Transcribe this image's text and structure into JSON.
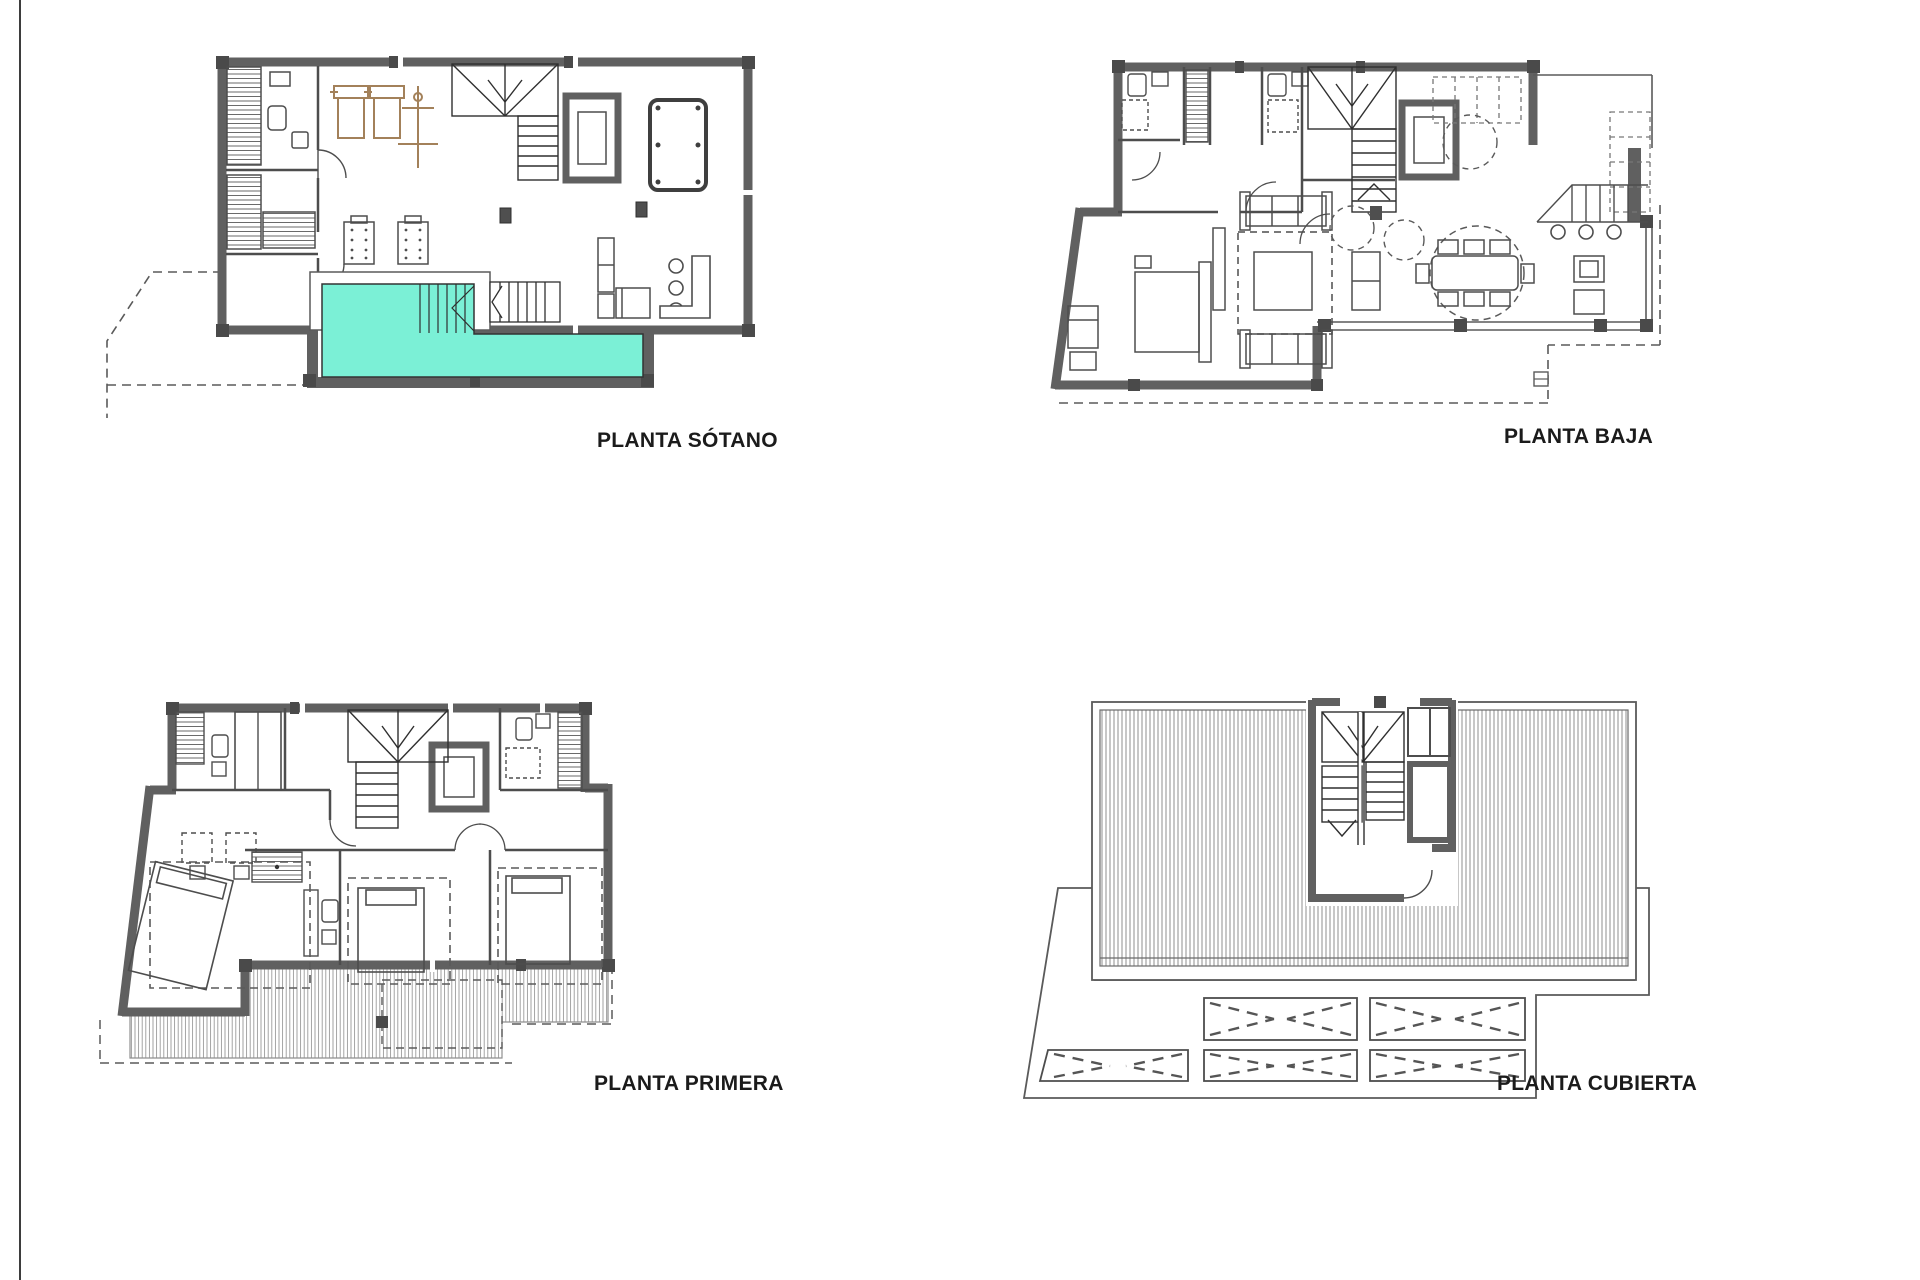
{
  "document": {
    "kind": "architectural-floor-plan-sheet",
    "sheet_background": "#ffffff",
    "page_edge_color": "#3d3d3d"
  },
  "palette": {
    "wall": "#606060",
    "pillar": "#4a4a4a",
    "line": "#4d4d4d",
    "thin_line": "#8f8f8f",
    "dashed": "#5a5a5a",
    "pool_fill": "#7bf0d6",
    "equipment": "#a3815a",
    "label_color": "#1b1b1b"
  },
  "plans": [
    {
      "id": "sotano",
      "label": "PLANTA SÓTANO",
      "features": [
        "swimming-pool",
        "pool-steps",
        "gym-equipment",
        "sauna",
        "massage-beds",
        "stairs",
        "elevator",
        "jacuzzi",
        "bar-counter",
        "site-boundary-dashed"
      ]
    },
    {
      "id": "baja",
      "label": "PLANTA BAJA",
      "features": [
        "bedroom",
        "living-room-sofas",
        "rug",
        "dining-table-8-chairs",
        "kitchen",
        "bar-stools",
        "stairs",
        "elevator",
        "terrace",
        "site-boundary-dashed"
      ]
    },
    {
      "id": "primera",
      "label": "PLANTA PRIMERA",
      "features": [
        "master-bedroom",
        "bedrooms",
        "bathrooms",
        "wardrobes",
        "stairs",
        "elevator",
        "terrace-decking",
        "site-boundary-dashed"
      ]
    },
    {
      "id": "cubierta",
      "label": "PLANTA CUBIERTA",
      "features": [
        "roof-decking",
        "stair-bulkhead",
        "shaft",
        "pergola-louvres",
        "site-boundary"
      ]
    }
  ]
}
